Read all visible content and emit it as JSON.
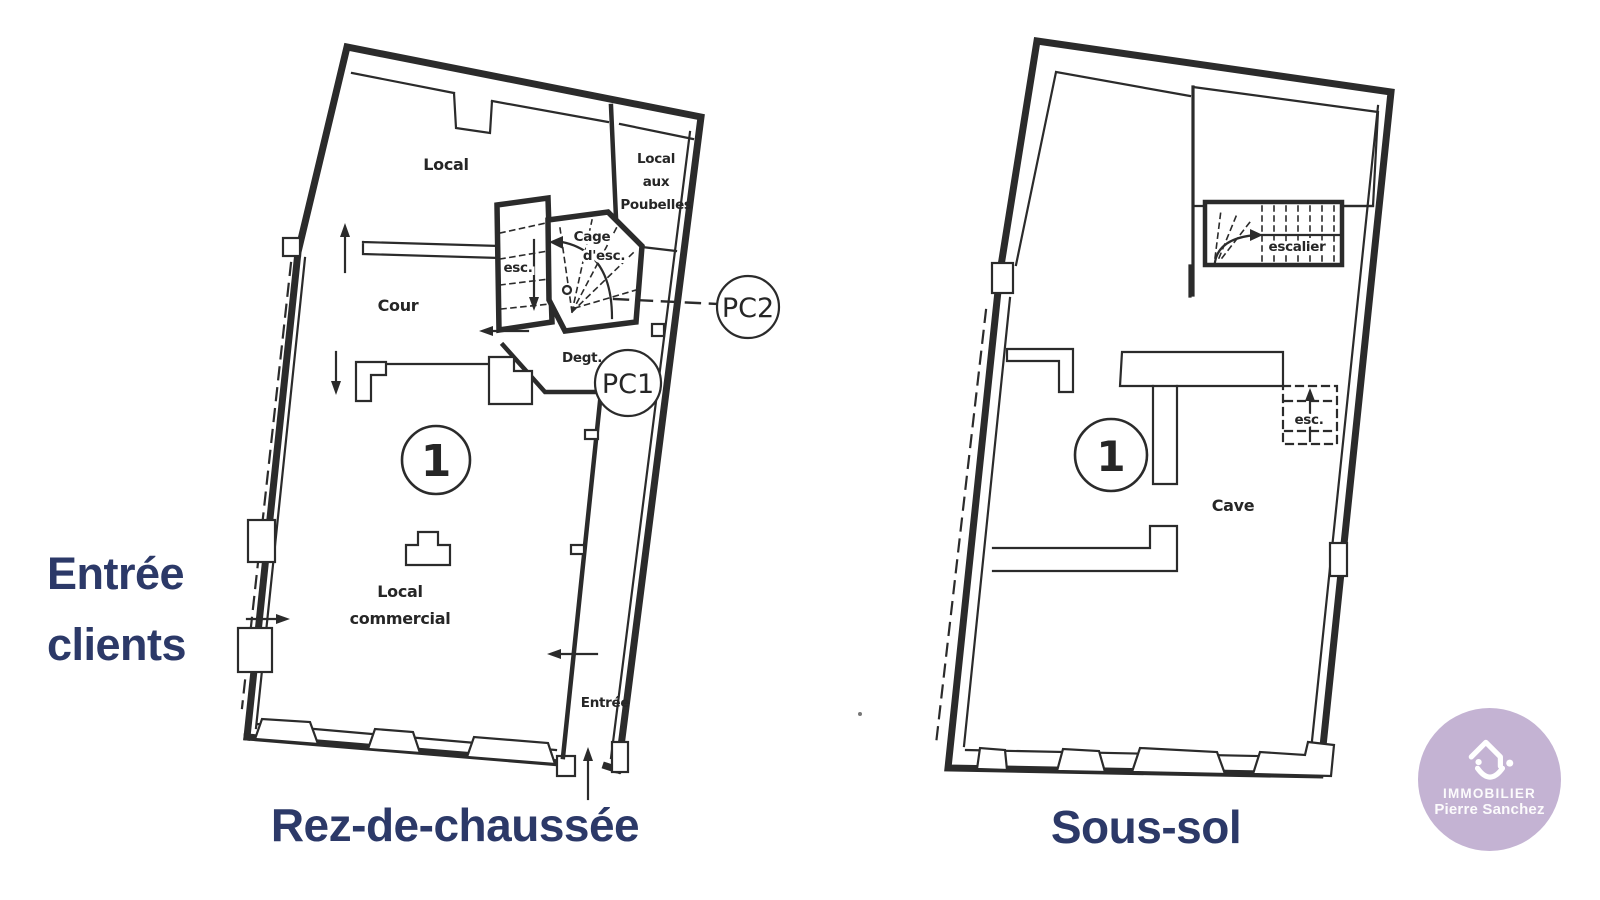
{
  "page": {
    "background": "#ffffff"
  },
  "colors": {
    "ink": "#2b2b2b",
    "accent": "#2c3968",
    "logo_bg": "#c4b3d3",
    "logo_text": "#ffffff"
  },
  "left_plan": {
    "caption": "Rez-de-chaussée",
    "labels": {
      "local": "Local",
      "poubelles": [
        "Local",
        "aux",
        "Poubelles"
      ],
      "cage": [
        "Cage",
        "d'esc."
      ],
      "esc": "esc.",
      "cour": "Cour",
      "degt": "Degt.",
      "pc1": "PC1",
      "pc2": "PC2",
      "unit": "1",
      "commercial": [
        "Local",
        "commercial"
      ],
      "entrance": "Entrée"
    }
  },
  "right_plan": {
    "caption": "Sous-sol",
    "labels": {
      "escalier": "escalier",
      "esc": "esc.",
      "unit": "1",
      "cave": "Cave"
    }
  },
  "annotation": {
    "line1": "Entrée",
    "line2": "clients"
  },
  "logo": {
    "icon": "house-smile-icon",
    "line1": "IMMOBILIER",
    "line2": "Pierre Sanchez"
  }
}
